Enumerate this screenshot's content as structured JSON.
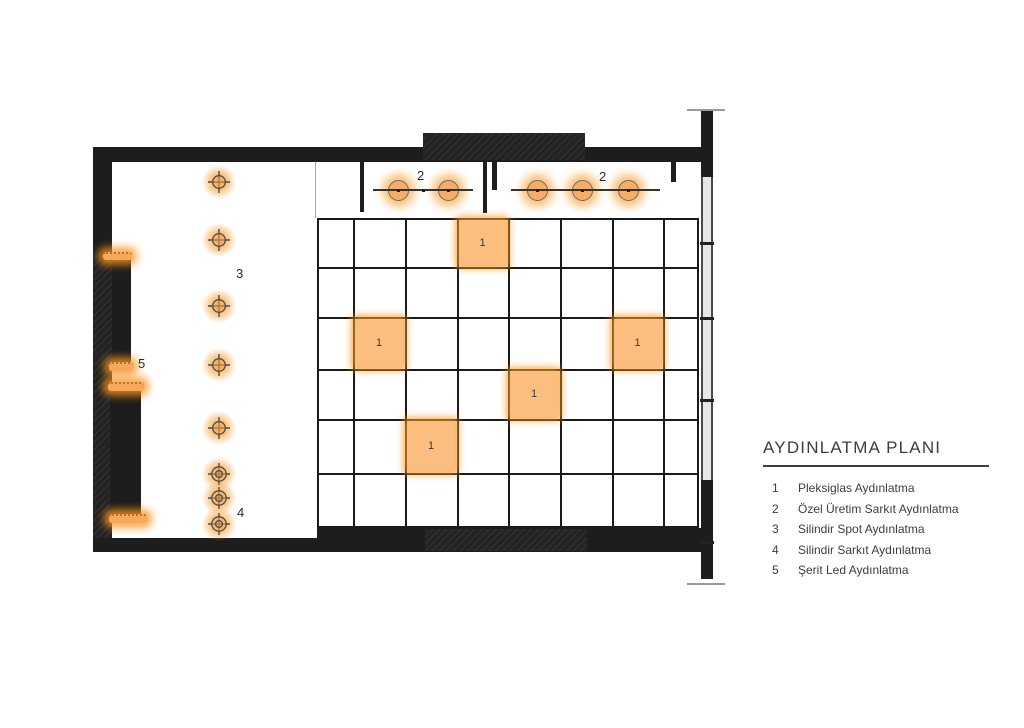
{
  "legend": {
    "title": "AYDINLATMA PLANI",
    "items": [
      {
        "num": "1",
        "label": "Pleksiglas Aydınlatma"
      },
      {
        "num": "2",
        "label": "Özel Üretim Sarkıt Aydınlatma"
      },
      {
        "num": "3",
        "label": "Silindir Spot Aydınlatma"
      },
      {
        "num": "4",
        "label": "Silindir Sarkıt Aydınlatma"
      },
      {
        "num": "5",
        "label": "Şerit Led Aydınlatma"
      }
    ]
  },
  "colors": {
    "wall": "#1d1d1d",
    "glow_orange": "#F7941D",
    "panel_fill": "#FBBE7E",
    "pendant_fill": "#F8AC64",
    "text": "#3d3d3d"
  },
  "fixtures": {
    "panels": [
      {
        "label": "1",
        "x": 459,
        "y": 220,
        "w": 47,
        "h": 45
      },
      {
        "label": "1",
        "x": 355,
        "y": 319,
        "w": 48,
        "h": 48
      },
      {
        "label": "1",
        "x": 614,
        "y": 319,
        "w": 47,
        "h": 48
      },
      {
        "label": "1",
        "x": 510,
        "y": 371,
        "w": 48,
        "h": 46
      },
      {
        "label": "1",
        "x": 407,
        "y": 421,
        "w": 48,
        "h": 50
      }
    ],
    "pendant_groups": [
      {
        "label": "2",
        "label_x": 417,
        "label_y": 168,
        "line_x1": 373,
        "line_x2": 473,
        "line_y": 190,
        "circles": [
          398,
          448
        ],
        "dots": [
          398,
          423,
          448
        ]
      },
      {
        "label": "2",
        "label_x": 599,
        "label_y": 169,
        "line_x1": 511,
        "line_x2": 660,
        "line_y": 190,
        "circles": [
          537,
          582,
          628
        ],
        "dots": [
          537,
          582,
          628
        ]
      }
    ],
    "spots": [
      {
        "x": 219,
        "y": 182
      },
      {
        "x": 219,
        "y": 240
      },
      {
        "x": 219,
        "y": 306
      },
      {
        "x": 219,
        "y": 365
      },
      {
        "x": 219,
        "y": 428
      }
    ],
    "double_spots": [
      {
        "x": 219,
        "y": 474
      },
      {
        "x": 219,
        "y": 498
      },
      {
        "x": 219,
        "y": 524
      }
    ],
    "led_strips": [
      {
        "x": 103,
        "y": 252,
        "w": 29,
        "h": 8
      },
      {
        "x": 109,
        "y": 362,
        "w": 24,
        "h": 9
      },
      {
        "x": 108,
        "y": 382,
        "w": 36,
        "h": 9
      },
      {
        "x": 109,
        "y": 514,
        "w": 38,
        "h": 9
      }
    ],
    "plan_labels": [
      {
        "text": "3",
        "x": 236,
        "y": 266
      },
      {
        "text": "4",
        "x": 237,
        "y": 505
      },
      {
        "text": "5",
        "x": 138,
        "y": 356
      }
    ]
  }
}
